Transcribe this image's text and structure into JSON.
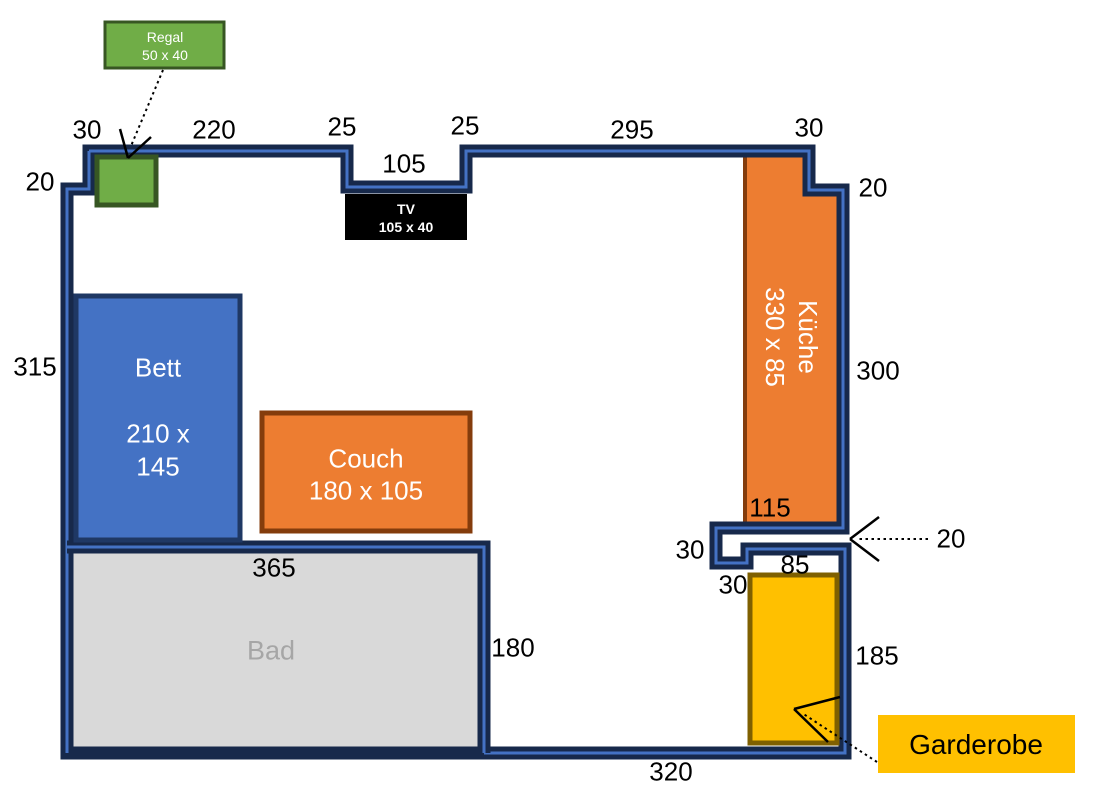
{
  "diagram": {
    "type": "floor-plan",
    "language": "de"
  },
  "colors": {
    "wall_dark": "#17294B",
    "wall_accent": "#4472C4",
    "bett_fill": "#4472C4",
    "bett_border": "#1F3864",
    "couch_fill": "#ED7D31",
    "couch_border": "#843C0C",
    "kueche_fill": "#ED7D31",
    "kueche_border": "#843C0C",
    "bad_fill": "#D9D9D9",
    "bad_border": "#17294B",
    "bad_text": "#A6A6A6",
    "garderobe_fill": "#FFC000",
    "garderobe_border": "#7F6000",
    "regal_fill": "#70AD47",
    "regal_border": "#375623",
    "tv_fill": "#000000",
    "arrow_color": "#000000",
    "text_light": "#FFFFFF",
    "text_dark": "#000000"
  },
  "furniture": {
    "bett": {
      "name": "Bett",
      "size_line1": "210 x",
      "size_line2": "145"
    },
    "couch": {
      "name": "Couch",
      "size": "180 x 105"
    },
    "kueche": {
      "name": "Küche",
      "size": "330 x 85"
    },
    "bad": {
      "name": "Bad"
    },
    "tv": {
      "name": "TV",
      "size": "105 x 40"
    },
    "regal": {
      "name": "Regal",
      "size": "50 x 40"
    },
    "garderobe": {
      "name": "Garderobe"
    }
  },
  "wall_dimensions": {
    "top_step_left": "30",
    "top_wall_left": "220",
    "niche_left": "25",
    "niche_width": "105",
    "niche_right": "25",
    "top_wall_right": "295",
    "top_step_right": "30",
    "right_step": "20",
    "left_step": "20",
    "left_wall": "315",
    "right_wall": "300",
    "kueche_width_bottom": "115",
    "door_gap": "20",
    "step_down": "30",
    "garderobe_wall_width": "85",
    "garderobe_top_offset": "30",
    "garderobe_right_wall": "185",
    "bad_width": "365",
    "bad_right_wall": "180",
    "bottom_wall": "320"
  }
}
